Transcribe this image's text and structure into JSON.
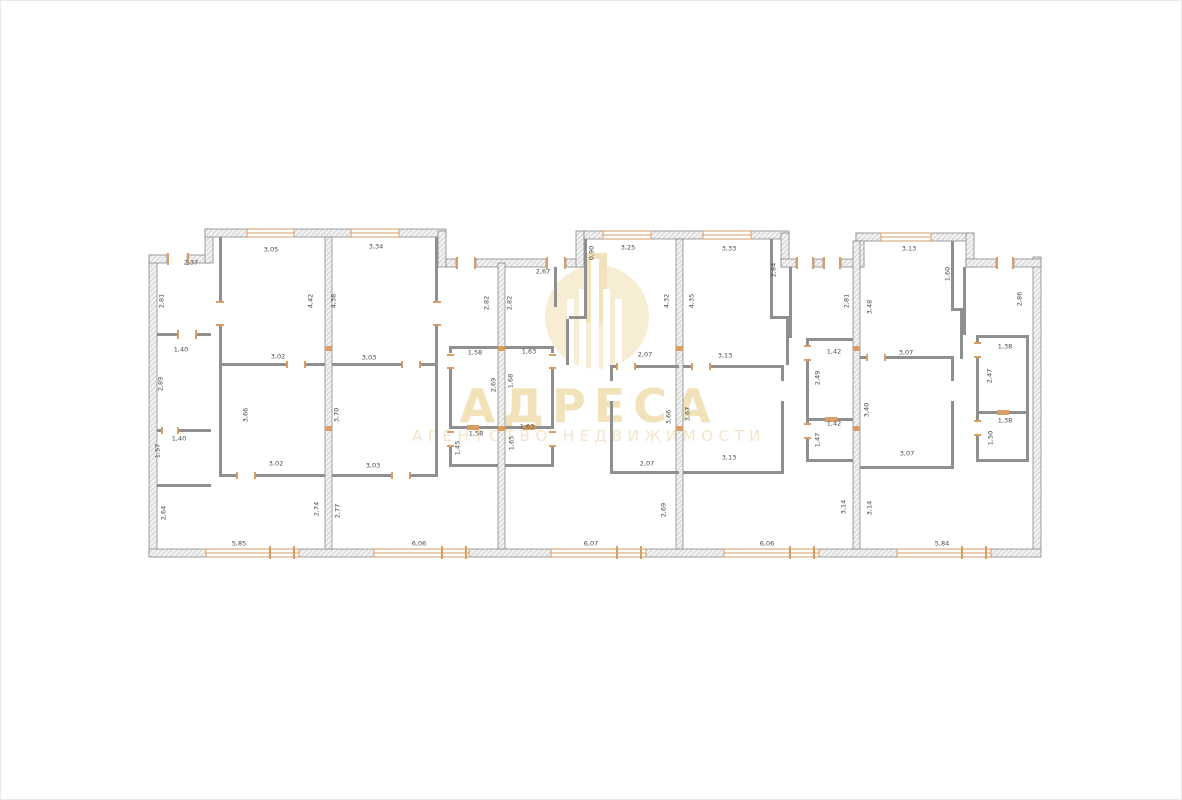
{
  "watermark": {
    "title": "АДРЕСА",
    "subtitle": "АГЕНТСТВО НЕДВИЖИМОСТИ",
    "color": "#f2e2ba"
  },
  "floorplan": {
    "wall_fill": "#f2f2f2",
    "wall_line": "#8a8a8a",
    "window_color": "#d79e66",
    "label_color": "#4a4a4a",
    "dimension_labels": [
      {
        "text": "2,37",
        "x": 190,
        "y": 262,
        "vertical": false
      },
      {
        "text": "3,05",
        "x": 270,
        "y": 249,
        "vertical": false
      },
      {
        "text": "2,81",
        "x": 161,
        "y": 300,
        "vertical": true
      },
      {
        "text": "1,40",
        "x": 180,
        "y": 349,
        "vertical": false
      },
      {
        "text": "2,89",
        "x": 160,
        "y": 383,
        "vertical": true
      },
      {
        "text": "1,40",
        "x": 178,
        "y": 438,
        "vertical": false
      },
      {
        "text": "1,57",
        "x": 157,
        "y": 450,
        "vertical": true
      },
      {
        "text": "4,42",
        "x": 310,
        "y": 300,
        "vertical": true
      },
      {
        "text": "3,02",
        "x": 277,
        "y": 356,
        "vertical": false
      },
      {
        "text": "3,66",
        "x": 245,
        "y": 414,
        "vertical": true
      },
      {
        "text": "3,02",
        "x": 275,
        "y": 463,
        "vertical": false
      },
      {
        "text": "2,64",
        "x": 163,
        "y": 512,
        "vertical": true
      },
      {
        "text": "2,74",
        "x": 316,
        "y": 508,
        "vertical": true
      },
      {
        "text": "5,85",
        "x": 238,
        "y": 543,
        "vertical": false
      },
      {
        "text": "3,34",
        "x": 375,
        "y": 246,
        "vertical": false
      },
      {
        "text": "4,38",
        "x": 333,
        "y": 300,
        "vertical": true
      },
      {
        "text": "3,03",
        "x": 368,
        "y": 357,
        "vertical": false
      },
      {
        "text": "3,70",
        "x": 336,
        "y": 414,
        "vertical": true
      },
      {
        "text": "3,03",
        "x": 372,
        "y": 465,
        "vertical": false
      },
      {
        "text": "2,77",
        "x": 337,
        "y": 510,
        "vertical": true
      },
      {
        "text": "6,06",
        "x": 418,
        "y": 543,
        "vertical": false
      },
      {
        "text": "2,82",
        "x": 486,
        "y": 302,
        "vertical": true
      },
      {
        "text": "1,58",
        "x": 474,
        "y": 352,
        "vertical": false
      },
      {
        "text": "2,69",
        "x": 493,
        "y": 384,
        "vertical": true
      },
      {
        "text": "1,58",
        "x": 475,
        "y": 433,
        "vertical": false
      },
      {
        "text": "1,45",
        "x": 457,
        "y": 447,
        "vertical": true
      },
      {
        "text": "2,67",
        "x": 542,
        "y": 271,
        "vertical": false
      },
      {
        "text": "2,82",
        "x": 509,
        "y": 302,
        "vertical": true
      },
      {
        "text": "1,63",
        "x": 528,
        "y": 351,
        "vertical": false
      },
      {
        "text": "1,68",
        "x": 510,
        "y": 380,
        "vertical": true
      },
      {
        "text": "1,63",
        "x": 526,
        "y": 426,
        "vertical": false
      },
      {
        "text": "1,65",
        "x": 511,
        "y": 442,
        "vertical": true
      },
      {
        "text": "0,90",
        "x": 591,
        "y": 252,
        "vertical": true
      },
      {
        "text": "3,25",
        "x": 627,
        "y": 247,
        "vertical": false
      },
      {
        "text": "4,32",
        "x": 666,
        "y": 300,
        "vertical": true
      },
      {
        "text": "2,07",
        "x": 644,
        "y": 354,
        "vertical": false
      },
      {
        "text": "3,66",
        "x": 668,
        "y": 416,
        "vertical": true
      },
      {
        "text": "2,07",
        "x": 646,
        "y": 463,
        "vertical": false
      },
      {
        "text": "2,69",
        "x": 663,
        "y": 509,
        "vertical": true
      },
      {
        "text": "6,07",
        "x": 590,
        "y": 543,
        "vertical": false
      },
      {
        "text": "3,33",
        "x": 728,
        "y": 248,
        "vertical": false
      },
      {
        "text": "4,35",
        "x": 691,
        "y": 300,
        "vertical": true
      },
      {
        "text": "2,84",
        "x": 773,
        "y": 269,
        "vertical": true
      },
      {
        "text": "3,13",
        "x": 724,
        "y": 355,
        "vertical": false
      },
      {
        "text": "3,67",
        "x": 687,
        "y": 413,
        "vertical": true
      },
      {
        "text": "3,13",
        "x": 728,
        "y": 457,
        "vertical": false
      },
      {
        "text": "2,81",
        "x": 846,
        "y": 300,
        "vertical": true
      },
      {
        "text": "1,42",
        "x": 833,
        "y": 351,
        "vertical": false
      },
      {
        "text": "2,49",
        "x": 817,
        "y": 377,
        "vertical": true
      },
      {
        "text": "1,42",
        "x": 833,
        "y": 423,
        "vertical": false
      },
      {
        "text": "1,47",
        "x": 817,
        "y": 439,
        "vertical": true
      },
      {
        "text": "3,14",
        "x": 843,
        "y": 506,
        "vertical": true
      },
      {
        "text": "6,06",
        "x": 766,
        "y": 543,
        "vertical": false
      },
      {
        "text": "3,13",
        "x": 908,
        "y": 248,
        "vertical": false
      },
      {
        "text": "3,48",
        "x": 869,
        "y": 306,
        "vertical": true
      },
      {
        "text": "1,60",
        "x": 947,
        "y": 273,
        "vertical": true
      },
      {
        "text": "2,86",
        "x": 1019,
        "y": 298,
        "vertical": true
      },
      {
        "text": "3,07",
        "x": 905,
        "y": 352,
        "vertical": false
      },
      {
        "text": "3,40",
        "x": 866,
        "y": 409,
        "vertical": true
      },
      {
        "text": "3,07",
        "x": 906,
        "y": 453,
        "vertical": false
      },
      {
        "text": "1,38",
        "x": 1004,
        "y": 346,
        "vertical": false
      },
      {
        "text": "2,47",
        "x": 989,
        "y": 375,
        "vertical": true
      },
      {
        "text": "1,38",
        "x": 1004,
        "y": 420,
        "vertical": false
      },
      {
        "text": "1,50",
        "x": 990,
        "y": 437,
        "vertical": true
      },
      {
        "text": "3,14",
        "x": 869,
        "y": 507,
        "vertical": true
      },
      {
        "text": "5,84",
        "x": 941,
        "y": 543,
        "vertical": false
      }
    ]
  }
}
